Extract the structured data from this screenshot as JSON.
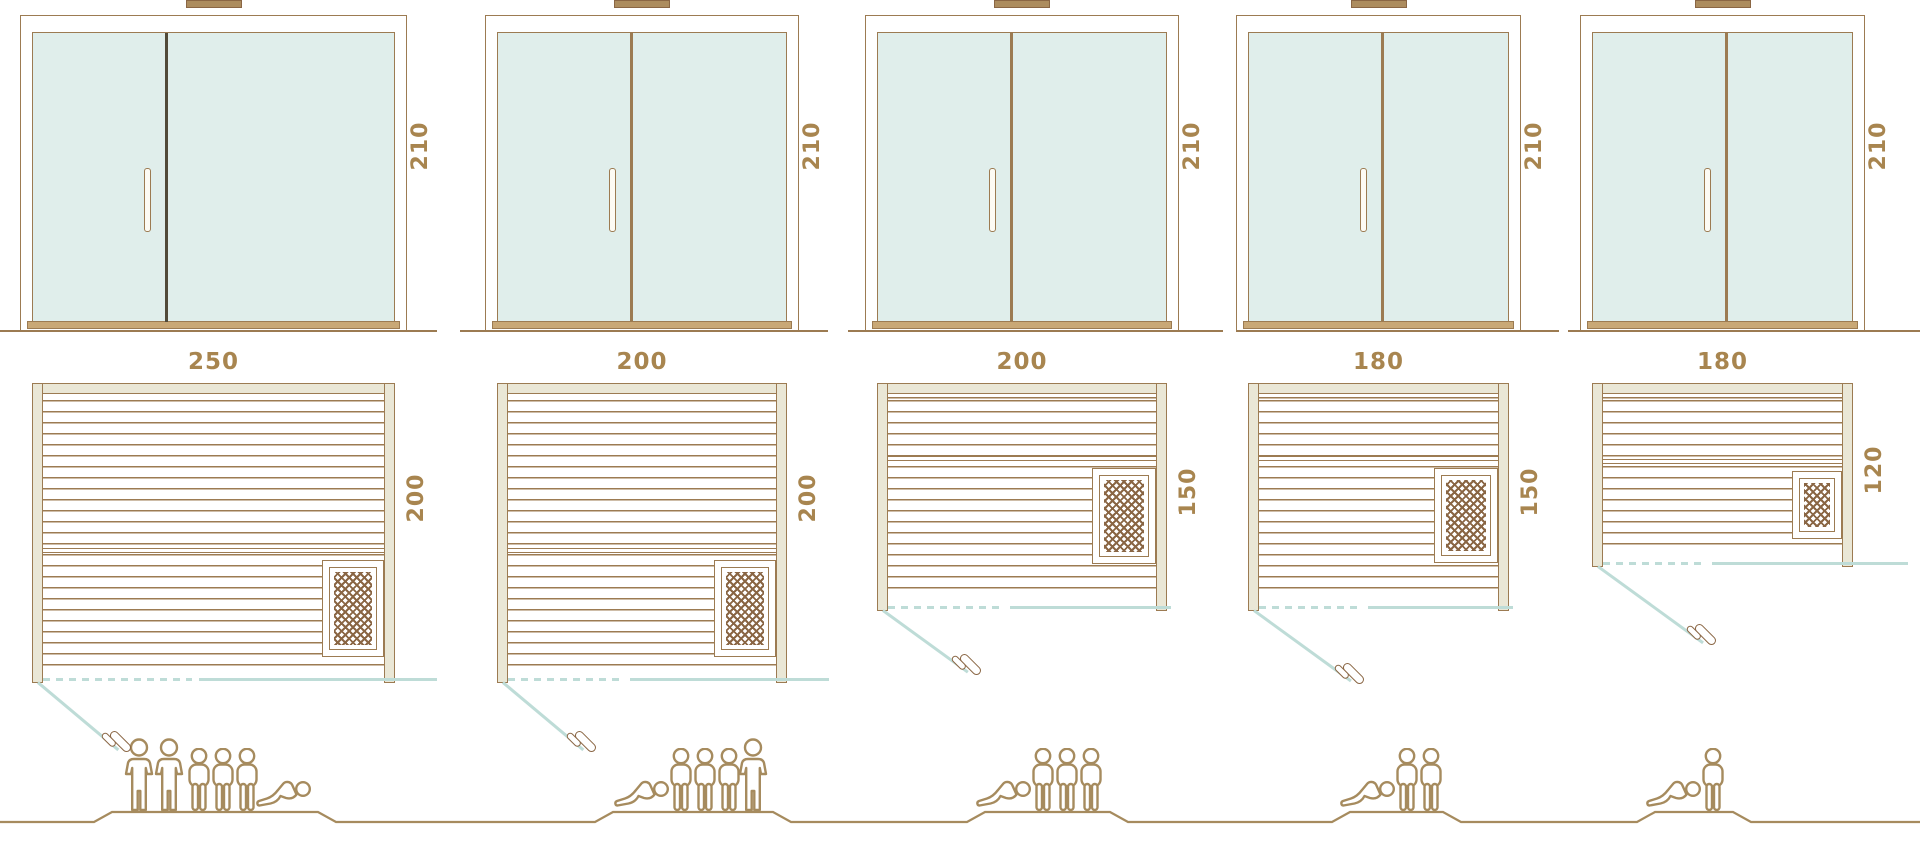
{
  "diagram": {
    "description": "Five sauna size variants: front door elevations with height, floor plans with width and depth, and capacity figures",
    "units": "cm"
  },
  "saunas": [
    {
      "name": "sauna-250x200",
      "door_height_cm": "210",
      "width_cm": "250",
      "depth_cm": "200",
      "capacity_total": 6,
      "capacity_arrangement": [
        "standing",
        "standing",
        "sitting",
        "sitting",
        "sitting",
        "lying"
      ]
    },
    {
      "name": "sauna-200x200",
      "door_height_cm": "210",
      "width_cm": "200",
      "depth_cm": "200",
      "capacity_total": 5,
      "capacity_arrangement": [
        "lying",
        "sitting",
        "sitting",
        "sitting",
        "standing"
      ]
    },
    {
      "name": "sauna-200x150",
      "door_height_cm": "210",
      "width_cm": "200",
      "depth_cm": "150",
      "capacity_total": 4,
      "capacity_arrangement": [
        "lying",
        "sitting",
        "sitting",
        "sitting"
      ]
    },
    {
      "name": "sauna-180x150",
      "door_height_cm": "210",
      "width_cm": "180",
      "depth_cm": "150",
      "capacity_total": 3,
      "capacity_arrangement": [
        "lying",
        "sitting",
        "sitting"
      ]
    },
    {
      "name": "sauna-180x120",
      "door_height_cm": "210",
      "width_cm": "180",
      "depth_cm": "120",
      "capacity_total": 2,
      "capacity_arrangement": [
        "lying",
        "sitting"
      ]
    }
  ],
  "colors": {
    "line_brown": "#9c7b52",
    "text_brown": "#a8854f",
    "glass_teal": "#e0eeeb",
    "frame_fill": "#eae7d6",
    "teal_line": "#bedcd7",
    "dark_divider": "#514a39",
    "hatch_brown": "#8a6644",
    "sill_tan": "#c9a876",
    "vent_tan": "#ac8c5e",
    "people_brown": "#a68b5e"
  }
}
